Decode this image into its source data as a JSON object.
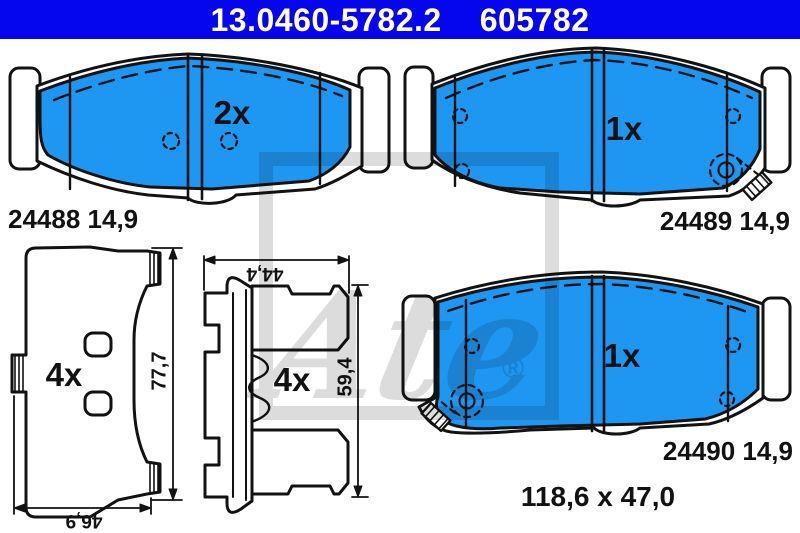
{
  "header": {
    "part_number": "13.0460-5782.2",
    "ref_number": "605782",
    "bg_color": "#0505EE",
    "text_color": "#FFFFFF"
  },
  "colors": {
    "pad_friction_blue": "#1E97F2",
    "outline_black": "#121212",
    "watermark_gray": "#DCDCDC",
    "background": "#FFFFFF"
  },
  "watermark": {
    "logo_text": "Ate",
    "registered_mark": "®"
  },
  "drawings": {
    "pad_top_left": {
      "quantity_label": "2x",
      "caption": "24488 14,9"
    },
    "pad_top_right": {
      "quantity_label": "1x",
      "caption": "24489 14,9"
    },
    "pad_bottom_right": {
      "quantity_label": "1x",
      "caption": "24490 14,9",
      "dim_overall": "118,6 x 47,0"
    },
    "backplate_view": {
      "quantity_label": "4x",
      "dim_height": "77,7",
      "dim_width": "46,9"
    },
    "profile_view": {
      "quantity_label": "4x",
      "dim_width": "44,4",
      "dim_height": "59,4"
    }
  }
}
